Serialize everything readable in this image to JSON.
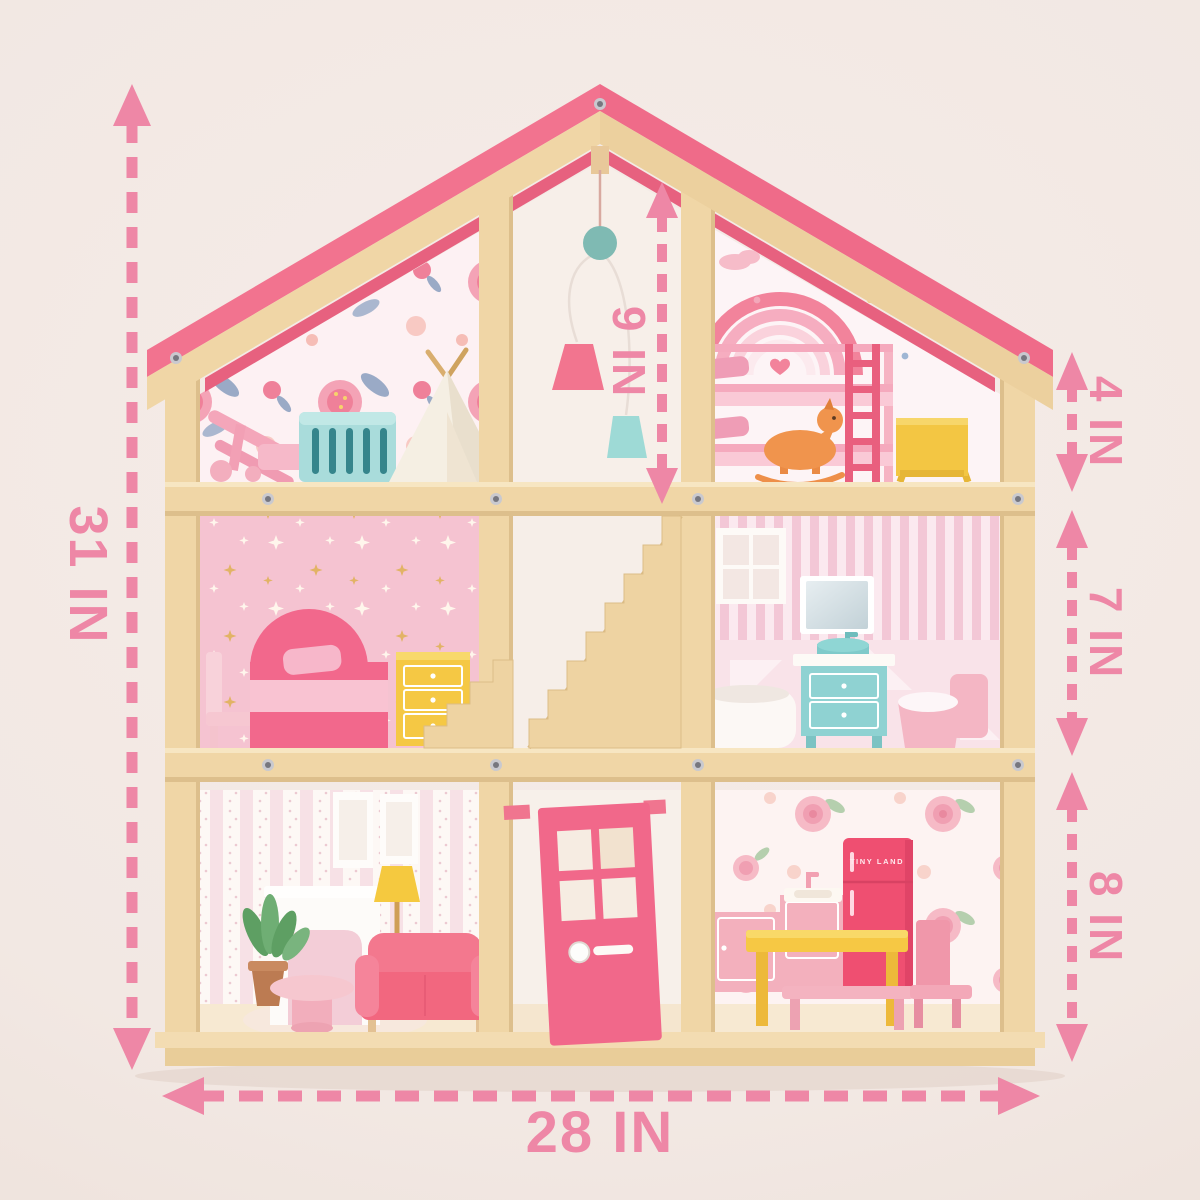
{
  "brand": {
    "fridge_label": "TINY LAND"
  },
  "dimensions": {
    "total_height": "31 IN",
    "total_width": "28 IN",
    "attic_height": "4 IN",
    "middle_floor_height": "7 IN",
    "ground_floor_height": "8 IN",
    "attic_interior_height": "9 IN"
  },
  "colors": {
    "background": "#f2e9e4",
    "annotation_pink": "#ee87a6",
    "roof_pink": "#f2738f",
    "wood": "#f0d6a6",
    "door_pink": "#f1688a",
    "fridge_pink": "#ef4f71"
  }
}
